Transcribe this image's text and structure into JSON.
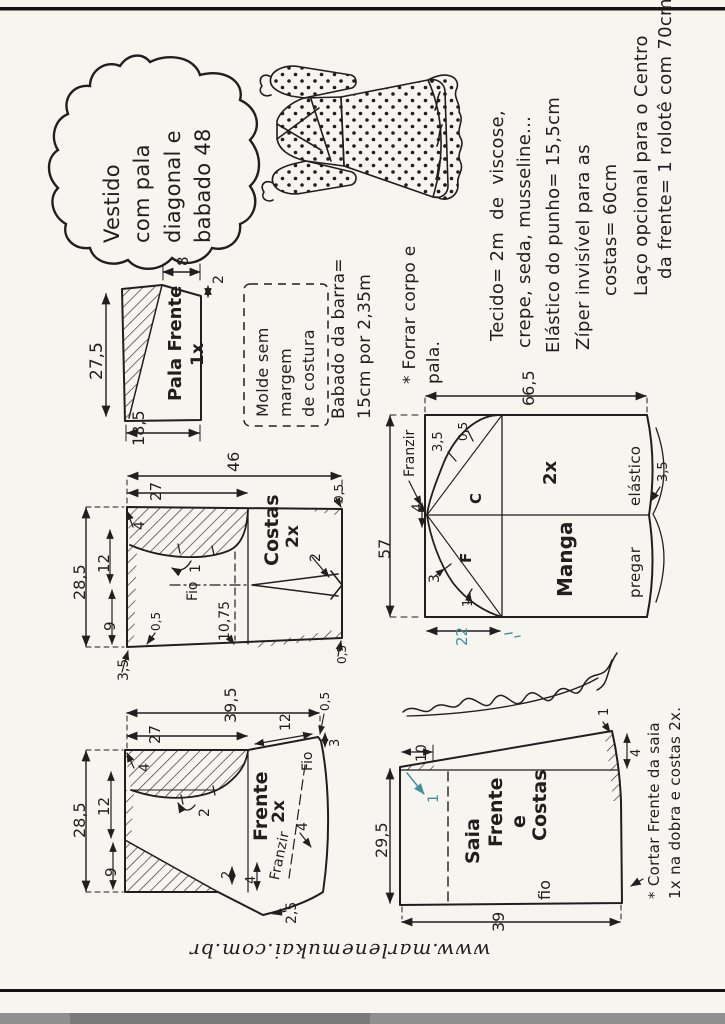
{
  "page": {
    "website": "www.marlenemukai.com.br",
    "bg": "#f6f5f0",
    "ink": "#1f1f1f",
    "teal": "#3f8fa0"
  },
  "title_cloud": {
    "text": "Vestido\ncom pala\ndiagonal e\nbabado 48"
  },
  "materials": {
    "lines": [
      "Tecido= 2m  de  viscose,",
      "crepe, seda, musseline...",
      "Elástico do punho= 15,5cm",
      "Zíper invisível para as",
      "costas= 60cm",
      "Laço opcional para o Centro",
      "da frente= 1 rolotê com 70cm"
    ]
  },
  "notes": {
    "mold": "Molde sem\nmargem\nde costura",
    "ruffle": "Babado da barra=\n15cm por 2,35m",
    "lining": "* Forrar corpo e\npala.",
    "skirt_cut_1": "* Cortar Frente da saia",
    "skirt_cut_2": "1x na dobra e costas 2x."
  },
  "pala": {
    "name": "Pala Frente",
    "qty": "1x",
    "d_left": "27,5",
    "d_top": "8",
    "d_corner": "2",
    "d_bottom": "18,5"
  },
  "costas": {
    "name": "Costas",
    "qty": "2x",
    "d_width": "46",
    "d_partial": "27",
    "d_height": "28,5",
    "d_shoulder": "4",
    "d_armhole": "12",
    "d_side": "9",
    "d_corner": "3,5",
    "d_seam_tr": "0,5",
    "d_seam_br": "0,5",
    "d_seam_bl": "0,5",
    "d_dart": "2",
    "d_notch": "1",
    "grain": "Fio",
    "d_hem": "10,75"
  },
  "manga": {
    "name": "Manga",
    "qty": "2x",
    "d_width": "66,5",
    "d_height": "57",
    "cap_back": "C",
    "cap_front": "F",
    "gather": "Franzir",
    "d_center": "4",
    "d_n1": "3,5",
    "d_n2": "0,5",
    "d_n3": "3",
    "d_n4": "1",
    "d_cuff": "22",
    "d_cuff_ease": "3,5",
    "elastic_upper": "elástico",
    "elastic_lower": "pregar"
  },
  "frente": {
    "name": "Frente",
    "qty": "2x",
    "d_width": "39,5",
    "d_partial": "27",
    "d_height": "28,5",
    "d_shoulder": "4",
    "d_armhole": "12",
    "d_side": "9",
    "d_dart": "2",
    "d_neck": "12",
    "d_neck_rise": "0,5",
    "d_neck_drop": "3",
    "grain": "Fio",
    "gather": "Franzir",
    "d_gather": "4",
    "d_hem1": "2",
    "d_hem2": "4",
    "d_flare": "2,5"
  },
  "saia": {
    "name_1": "Saia",
    "name_2": "Frente",
    "name_3": "e",
    "name_4": "Costas",
    "grain": "fio",
    "d_height": "29,5",
    "d_width": "39",
    "d_waist": "10",
    "d_drop": "1",
    "d_corner_notch": "1",
    "d_corner": "4"
  }
}
